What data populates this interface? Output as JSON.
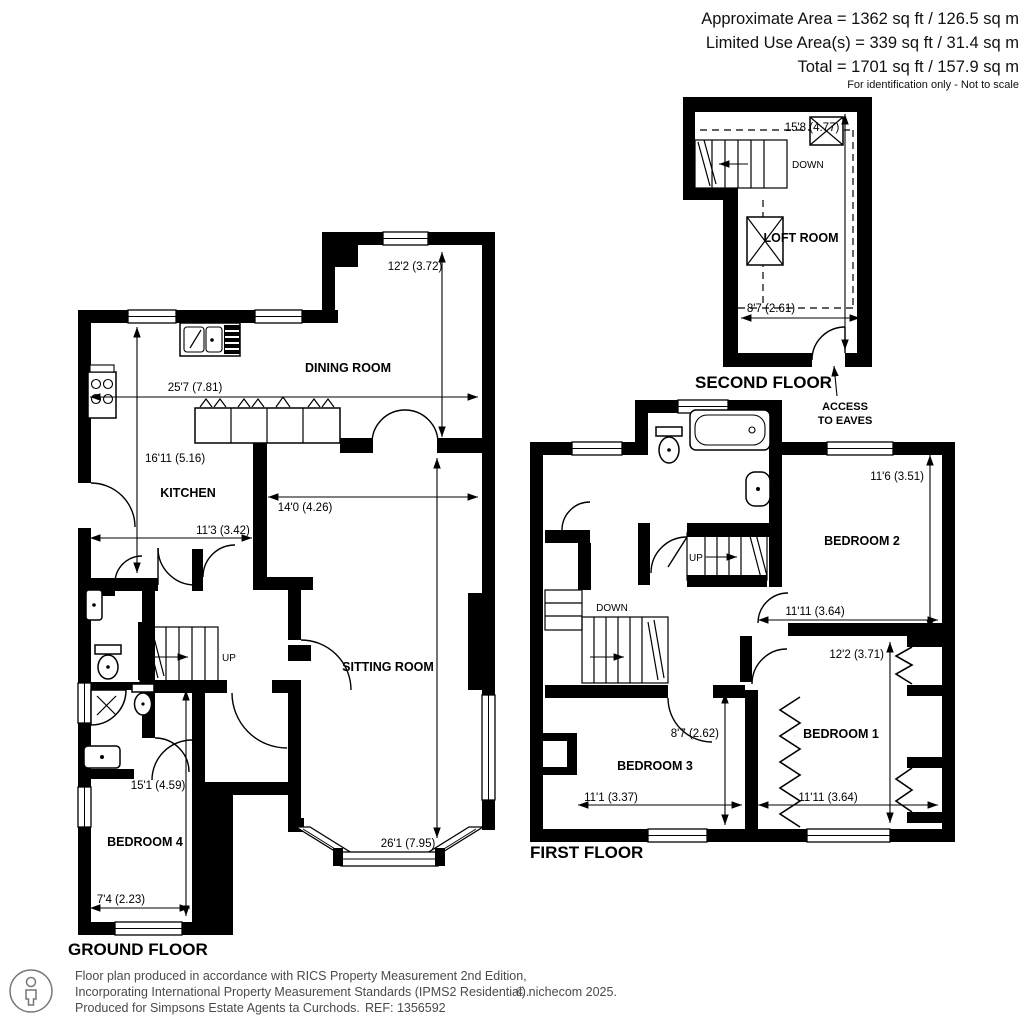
{
  "header": {
    "approx": "Approximate Area = 1362 sq ft / 126.5 sq m",
    "limited": "Limited Use Area(s) = 339 sq ft / 31.4 sq m",
    "total": "Total = 1701 sq ft / 157.9 sq m",
    "note": "For identification only - Not to scale"
  },
  "ground": {
    "label": "GROUND FLOOR",
    "rooms": {
      "dining": "DINING ROOM",
      "kitchen": "KITCHEN",
      "sitting": "SITTING ROOM",
      "bedroom4": "BEDROOM 4"
    },
    "dims": {
      "dining_depth": "12'2 (3.72)",
      "overall_width": "25'7 (7.81)",
      "kitchen_depth": "16'11 (5.16)",
      "kitchen_width": "11'3 (3.42)",
      "sitting_width": "14'0 (4.26)",
      "sitting_depth": "26'1 (7.95)",
      "bed4_depth": "15'1 (4.59)",
      "bed4_width": "7'4 (2.23)"
    },
    "stairs_up": "UP"
  },
  "first": {
    "label": "FIRST FLOOR",
    "rooms": {
      "bedroom1": "BEDROOM 1",
      "bedroom2": "BEDROOM 2",
      "bedroom3": "BEDROOM 3"
    },
    "dims": {
      "bed2_depth": "11'6 (3.51)",
      "bed2_width": "11'11 (3.64)",
      "bed1_depth": "12'2 (3.71)",
      "bed1_width": "11'11 (3.64)",
      "bed3_depth": "8'7 (2.62)",
      "bed3_width": "11'1 (3.37)"
    },
    "stairs_up": "UP",
    "stairs_down": "DOWN"
  },
  "second": {
    "label": "SECOND FLOOR",
    "rooms": {
      "loft": "LOFT ROOM"
    },
    "dims": {
      "depth": "15'8 (4.77)",
      "width": "8'7 (2.61)"
    },
    "stairs_down": "DOWN",
    "access_line1": "ACCESS",
    "access_line2": "TO EAVES"
  },
  "footer": {
    "line1": "Floor plan produced in accordance with RICS Property Measurement 2nd Edition,",
    "line2": "Incorporating International Property Measurement Standards (IPMS2 Residential).",
    "copyright": "© nichecom 2025.",
    "line3": "Produced for Simpsons Estate Agents ta Curchods.",
    "ref": "REF: 1356592"
  }
}
